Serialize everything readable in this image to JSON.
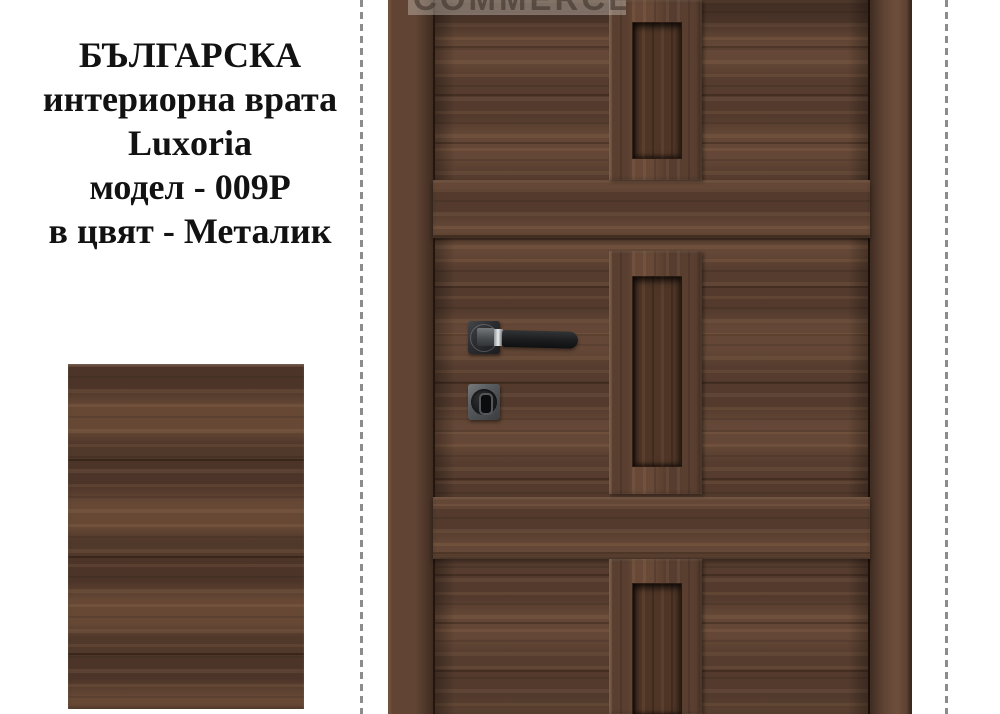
{
  "title": {
    "lines": [
      "БЪЛГАРСКА",
      "интериорна врата",
      "Luxoria",
      "модел - 009P",
      "в цвят - Металик"
    ]
  },
  "watermark": {
    "text": "COMMERCE"
  },
  "colors": {
    "background": "#ffffff",
    "text": "#121212",
    "divider_dash": "#8c8c8c",
    "wood_base": "#5c4132",
    "wood_light_streak": "#7a573f",
    "wood_dark_line": "#3a2519",
    "slot_recess": "#4e3526",
    "handle_black": "#1b1c1e",
    "hardware_gray": "#56595c",
    "chrome_highlight": "#e9ebed"
  }
}
